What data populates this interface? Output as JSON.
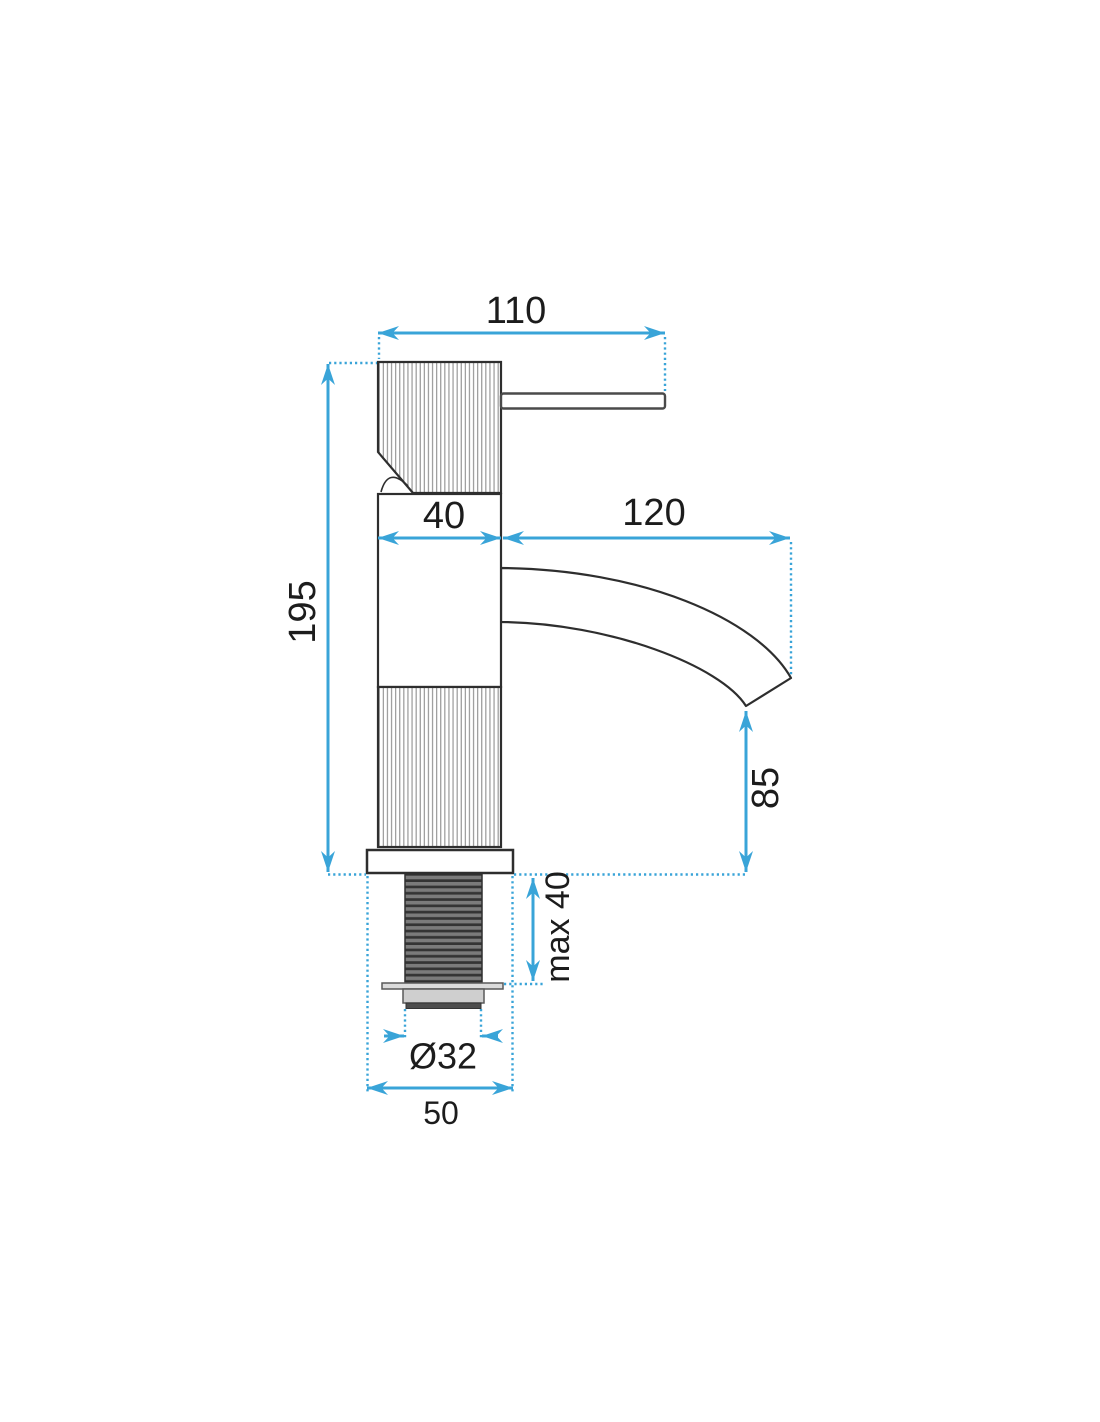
{
  "diagram": {
    "accent_color": "#39a4d8",
    "outline_color": "#2e2e2e",
    "dims": {
      "width_top": "110",
      "body_width": "40",
      "spout_reach": "120",
      "total_height": "195",
      "spout_height": "85",
      "mount_max_thickness": "max 40",
      "thread_diameter": "Ø32",
      "base_width": "50"
    }
  }
}
